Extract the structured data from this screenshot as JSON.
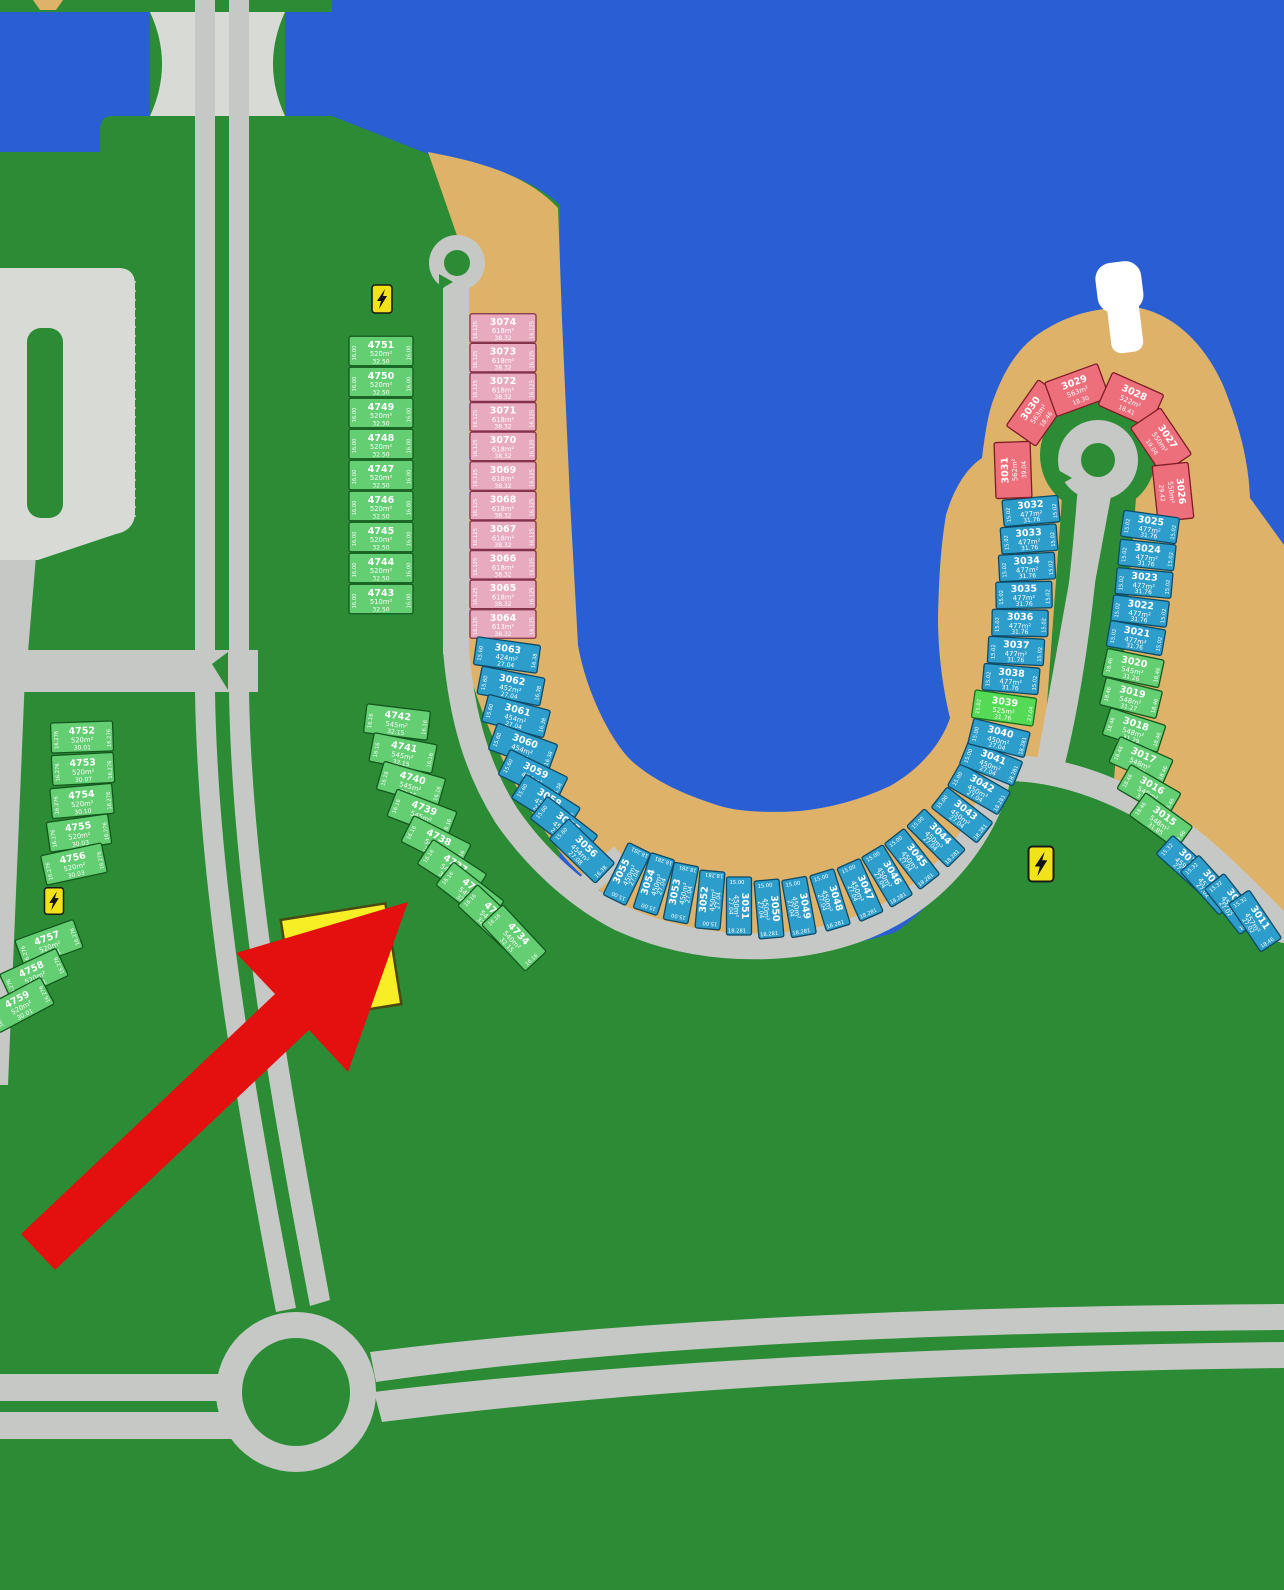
{
  "map": {
    "kind": "residential masterplan plot map",
    "colors": {
      "land": "#2B8C35",
      "water": "#2A5FD3",
      "sand": "#DFB269",
      "road": "#C6C8C5",
      "lot_green": "#63CE72",
      "lot_lime": "#54DA54",
      "lot_blue": "#2D9DCB",
      "lot_pink": "#E8AABF",
      "lot_red": "#EE6F7C",
      "sign": "#F2E318",
      "highlight": "#F8EE26",
      "arrow": "#E3100F"
    },
    "icons": {
      "electricity_sign": "high-voltage-bolt",
      "pier": "boat-pier",
      "roundabout": "roundabout",
      "highlight_arrow": "red-arrow-pointer"
    }
  },
  "groups": [
    {
      "id": "lg1",
      "palette": "green",
      "sides": [
        "16.00",
        "16.00"
      ],
      "lots": [
        {
          "n": "4751",
          "a": "520m²",
          "d": "32.50"
        },
        {
          "n": "4750",
          "a": "520m²",
          "d": "32.50"
        },
        {
          "n": "4749",
          "a": "520m²",
          "d": "32.50"
        },
        {
          "n": "4748",
          "a": "520m²",
          "d": "32.50"
        },
        {
          "n": "4747",
          "a": "520m²",
          "d": "32.50"
        },
        {
          "n": "4746",
          "a": "520m²",
          "d": "32.50"
        },
        {
          "n": "4745",
          "a": "520m²",
          "d": "32.50"
        },
        {
          "n": "4744",
          "a": "520m²",
          "d": "32.50"
        },
        {
          "n": "4743",
          "a": "510m²",
          "d": "32.50"
        }
      ]
    },
    {
      "id": "lg2",
      "palette": "pink",
      "sides": [
        "16.125",
        "16.125"
      ],
      "lots": [
        {
          "n": "3074",
          "a": "618m²",
          "d": "38.32"
        },
        {
          "n": "3073",
          "a": "618m²",
          "d": "38.32"
        },
        {
          "n": "3072",
          "a": "618m²",
          "d": "38.32"
        },
        {
          "n": "3071",
          "a": "618m²",
          "d": "38.32"
        },
        {
          "n": "3070",
          "a": "618m²",
          "d": "38.32"
        },
        {
          "n": "3069",
          "a": "618m²",
          "d": "38.32"
        },
        {
          "n": "3068",
          "a": "618m²",
          "d": "38.32"
        },
        {
          "n": "3067",
          "a": "618m²",
          "d": "38.32"
        },
        {
          "n": "3066",
          "a": "618m²",
          "d": "38.32"
        },
        {
          "n": "3065",
          "a": "618m²",
          "d": "38.32"
        },
        {
          "n": "3064",
          "a": "613m²",
          "d": "38.32"
        }
      ]
    },
    {
      "id": "lg3",
      "palette": "blue",
      "sides": [
        "15.60",
        "16.38"
      ],
      "lots": [
        {
          "n": "3063",
          "a": "424m²",
          "d": "27.04"
        },
        {
          "n": "3062",
          "a": "452m²",
          "d": "27.04"
        },
        {
          "n": "3061",
          "a": "454m²",
          "d": "27.04"
        },
        {
          "n": "3060",
          "a": "454m²",
          "d": "27.04"
        },
        {
          "n": "3059",
          "a": "454m²",
          "d": "27.04"
        },
        {
          "n": "3058",
          "a": "454m²",
          "d": "27.04"
        },
        {
          "n": "3057",
          "a": "454m²",
          "d": "27.04"
        },
        {
          "n": "3056",
          "a": "454m²",
          "d": "27.08"
        }
      ]
    },
    {
      "id": "lg4",
      "palette": "blue",
      "sides": [
        "15.00",
        "18.281"
      ],
      "lots": [
        {
          "n": "3055",
          "a": "450m²",
          "d": "27.04"
        },
        {
          "n": "3054",
          "a": "450m²",
          "d": "27.04"
        },
        {
          "n": "3053",
          "a": "450m²",
          "d": "27.04"
        },
        {
          "n": "3052",
          "a": "450m²",
          "d": "27.04"
        },
        {
          "n": "3051",
          "a": "450m²",
          "d": "27.04"
        },
        {
          "n": "3050",
          "a": "450m²",
          "d": "27.04"
        },
        {
          "n": "3049",
          "a": "450m²",
          "d": "27.04"
        },
        {
          "n": "3048",
          "a": "450m²",
          "d": "27.04"
        },
        {
          "n": "3047",
          "a": "450m²",
          "d": "27.04"
        },
        {
          "n": "3046",
          "a": "450m²",
          "d": "27.04"
        },
        {
          "n": "3045",
          "a": "450m²",
          "d": "27.04"
        },
        {
          "n": "3044",
          "a": "450m²",
          "d": "27.04"
        }
      ]
    },
    {
      "id": "lg5",
      "palette": "blue",
      "sides": [
        "15.00",
        "18.281"
      ],
      "lots": [
        {
          "n": "3043",
          "a": "450m²",
          "d": "27.04"
        },
        {
          "n": "3042",
          "a": "450m²",
          "d": "27.04"
        },
        {
          "n": "3041",
          "a": "450m²",
          "d": "27.04"
        },
        {
          "n": "3040",
          "a": "450m²",
          "d": "27.04"
        }
      ]
    },
    {
      "id": "lg6",
      "palette": "lime",
      "sides": [
        "15.02",
        "27.04"
      ],
      "lots": [
        {
          "n": "3039",
          "a": "525m²",
          "d": "31.76"
        }
      ]
    },
    {
      "id": "lg7",
      "palette": "blue",
      "sides": [
        "15.02",
        "15.02"
      ],
      "lots": [
        {
          "n": "3038",
          "a": "477m²",
          "d": "31.76"
        },
        {
          "n": "3037",
          "a": "477m²",
          "d": "31.76"
        },
        {
          "n": "3036",
          "a": "477m²",
          "d": "31.76"
        },
        {
          "n": "3035",
          "a": "477m²",
          "d": "31.76"
        },
        {
          "n": "3034",
          "a": "477m²",
          "d": "31.76"
        },
        {
          "n": "3033",
          "a": "477m²",
          "d": "31.76"
        },
        {
          "n": "3032",
          "a": "477m²",
          "d": "31.76"
        }
      ]
    },
    {
      "id": "lg8",
      "palette": "red",
      "sides": null,
      "lots": [
        {
          "n": "3031",
          "a": "562m²",
          "d": "39.04"
        },
        {
          "n": "3030",
          "a": "563m²",
          "d": "18.46"
        },
        {
          "n": "3029",
          "a": "563m²",
          "d": "18.30"
        },
        {
          "n": "3028",
          "a": "522m²",
          "d": "18.41"
        },
        {
          "n": "3027",
          "a": "550m²",
          "d": "19.04"
        },
        {
          "n": "3026",
          "a": "550m²",
          "d": "29.42"
        }
      ]
    },
    {
      "id": "lg9",
      "palette": "blue",
      "sides": [
        "15.02",
        "15.02"
      ],
      "lots": [
        {
          "n": "3025",
          "a": "477m²",
          "d": "31.76"
        },
        {
          "n": "3024",
          "a": "477m²",
          "d": "31.76"
        },
        {
          "n": "3023",
          "a": "477m²",
          "d": "31.76"
        },
        {
          "n": "3022",
          "a": "477m²",
          "d": "31.76"
        },
        {
          "n": "3021",
          "a": "477m²",
          "d": "31.76"
        }
      ]
    },
    {
      "id": "lg10",
      "palette": "green",
      "sides": [
        "18.46",
        "18.46"
      ],
      "lots": [
        {
          "n": "3020",
          "a": "545m²",
          "d": "31.26"
        },
        {
          "n": "3019",
          "a": "548m²",
          "d": "31.27"
        },
        {
          "n": "3018",
          "a": "548m²",
          "d": "31.29"
        },
        {
          "n": "3017",
          "a": "548m²",
          "d": "31.80"
        },
        {
          "n": "3016",
          "a": "548m²",
          "d": "31.83"
        },
        {
          "n": "3015",
          "a": "548m²",
          "d": "31.85"
        }
      ]
    },
    {
      "id": "lg11",
      "palette": "blue",
      "sides": [
        "15.32",
        "18.46"
      ],
      "lots": [
        {
          "n": "3014",
          "a": "459m²",
          "d": "27.00"
        },
        {
          "n": "3013",
          "a": "457m²",
          "d": "27.02"
        },
        {
          "n": "3012",
          "a": "457m²",
          "d": "27.02"
        },
        {
          "n": "3011",
          "a": "457m²",
          "d": "27.02"
        }
      ]
    },
    {
      "id": "lg12",
      "palette": "green",
      "sides": [
        "16.16",
        "16.16"
      ],
      "lots": [
        {
          "n": "4742",
          "a": "545m²",
          "d": "32.15"
        },
        {
          "n": "4741",
          "a": "545m²",
          "d": "32.15"
        },
        {
          "n": "4740",
          "a": "545m²",
          "d": "32.15"
        },
        {
          "n": "4739",
          "a": "545m²",
          "d": "32.15"
        },
        {
          "n": "4738",
          "a": "545m²",
          "d": "32.15"
        },
        {
          "n": "4737",
          "a": "545m²",
          "d": "32.15"
        },
        {
          "n": "4736",
          "a": "545m²",
          "d": "32.15"
        },
        {
          "n": "4735",
          "a": "545m²",
          "d": "32.15"
        },
        {
          "n": "4734",
          "a": "540m²",
          "d": "32.15"
        }
      ]
    },
    {
      "id": "lg13",
      "palette": "green",
      "sides": [
        "16.276",
        "16.276"
      ],
      "lots": [
        {
          "n": "4752",
          "a": "520m²",
          "d": "30.01"
        },
        {
          "n": "4753",
          "a": "520m²",
          "d": "30.07"
        },
        {
          "n": "4754",
          "a": "520m²",
          "d": "30.10"
        },
        {
          "n": "4755",
          "a": "520m²",
          "d": "30.03"
        },
        {
          "n": "4756",
          "a": "520m²",
          "d": "30.03"
        }
      ]
    },
    {
      "id": "lg14",
      "palette": "green",
      "sides": [
        "16.276",
        "16.276"
      ],
      "lots": [
        {
          "n": "4757",
          "a": "520m²",
          "d": "30.01"
        },
        {
          "n": "4758",
          "a": "520m²",
          "d": "30.01"
        },
        {
          "n": "4759",
          "a": "520m²",
          "d": "30.01"
        }
      ]
    }
  ]
}
